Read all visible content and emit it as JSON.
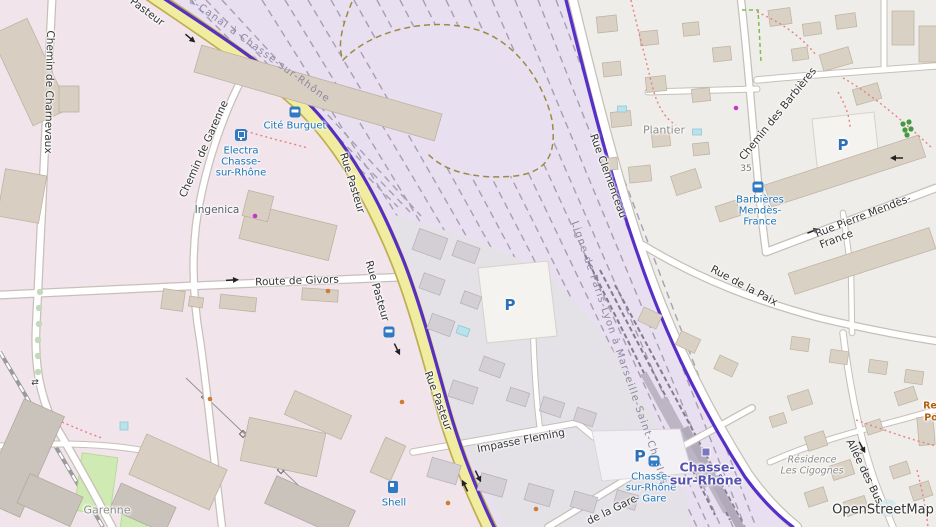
{
  "attribution": {
    "text": "OpenStreetMap"
  },
  "labels": {
    "streets": [
      {
        "text": "Chemin de Charnevaux"
      },
      {
        "text": "Chemin de Garenne"
      },
      {
        "text": "Pasteur"
      },
      {
        "text": "Rue Pasteur"
      },
      {
        "text": "Rue Pasteur"
      },
      {
        "text": "Rue Pasteur"
      },
      {
        "text": "Route de Givors"
      },
      {
        "text": "Impasse Fleming"
      },
      {
        "text": "de la Gare"
      },
      {
        "text": "Rue Clemenceau"
      },
      {
        "text": "Chemin des Barbières"
      },
      {
        "text": "Rue de la Paix"
      },
      {
        "text": "Rue Pierre Mendès-France"
      },
      {
        "text": "Allée des Bus"
      }
    ],
    "railways": [
      {
        "text": "Ligne de Givors-Canal à Chasse-sur-Rhône"
      },
      {
        "text": "Ligne de Paris-Lyon à Marseille-Saint-Charles"
      }
    ],
    "places": [
      {
        "text": "Ingenica"
      },
      {
        "text": "Plantier"
      },
      {
        "text": "Garenne"
      },
      {
        "text": "Résidence"
      },
      {
        "text": "Les Cigognes"
      },
      {
        "text": "Re"
      },
      {
        "text": "Po"
      }
    ],
    "house_numbers": [
      {
        "text": "35"
      }
    ]
  },
  "transit": {
    "cite_burguet": {
      "name": "Cité Burguet"
    },
    "electra": {
      "line1": "Electra",
      "line2": "Chasse-",
      "line3": "sur-Rhône"
    },
    "barbieres": {
      "line1": "Barbières",
      "line2": "Mendès-",
      "line3": "France"
    },
    "gare_parking": {
      "line1": "Chasse-",
      "line2": "sur-Rhône",
      "line3": "- Gare"
    },
    "station": {
      "line1": "Chasse-",
      "line2": "sur-Rhône"
    },
    "shell": {
      "name": "Shell"
    }
  },
  "icons": {
    "parking_glyph": "P",
    "crossing_glyph": "⇄"
  },
  "colors": {
    "residential_bg": "#efede9",
    "industrial_pink": "#f1e5eb",
    "railway_corridor": "#e8dff0",
    "station_grey": "#e4e1e7",
    "road_yellow": "#f1eda0",
    "route_purple": "#4f27c4",
    "transit_blue": "#1b72b8",
    "station_label_purple": "#5752ae"
  }
}
